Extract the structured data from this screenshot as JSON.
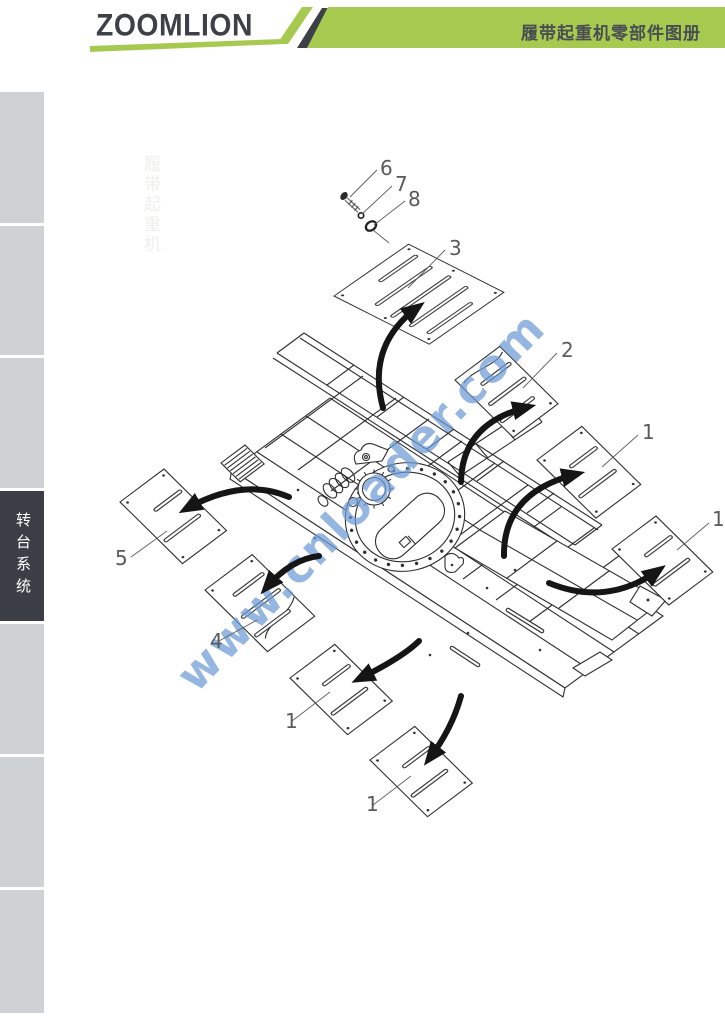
{
  "header": {
    "brand": "ZOOMLION",
    "catalog_title": "履带起重机零部件图册"
  },
  "sidebar": {
    "active_label": "转台系统"
  },
  "diagram": {
    "watermark": "www.cnloader.com",
    "faint_vertical_text": "履带起重机",
    "callouts": {
      "bolt": "6",
      "flat_washer": "7",
      "lock_washer": "8",
      "plate_top": "3",
      "plate_upper_right": "2",
      "plate_right": "1",
      "plate_far_right": "1",
      "plate_left": "5",
      "plate_lower_left": "4",
      "plate_bottom_left": "1",
      "plate_bottom_right": "1"
    }
  },
  "colors": {
    "brand_green": "#a6c94f",
    "dark_slate": "#3d4147",
    "tab_gray": "#cfd2d5",
    "tab_active": "#3b3f45",
    "watermark_blue": "#6f9bd8"
  }
}
